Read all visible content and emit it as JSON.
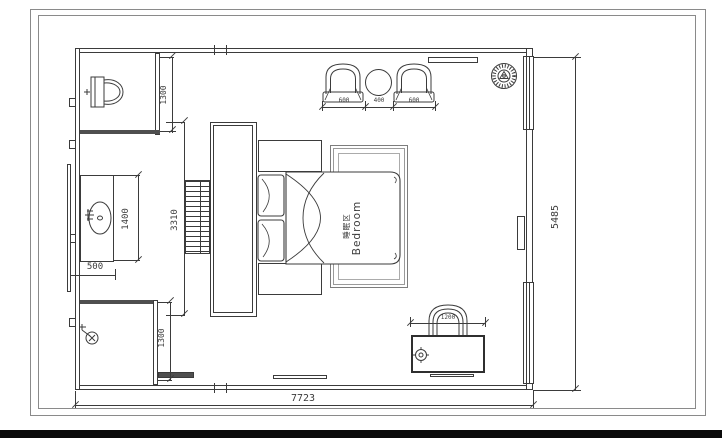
{
  "room": {
    "label_zh": "睡眠区",
    "label_en": "Bedroom"
  },
  "dims": {
    "overall_width": "7723",
    "overall_height": "5485",
    "wc_depth": "1300",
    "shower_depth": "1300",
    "vanity_length": "1400",
    "vanity_depth": "500",
    "wardrobe_length": "3310",
    "seating": [
      "600",
      "400",
      "600"
    ],
    "desk_width": "1200"
  },
  "icons": {
    "toilet-icon": "toilet plan symbol",
    "sink-icon": "wash basin with faucet",
    "shower-icon": "wall-mounted shower head",
    "ceiling-fan-icon": "round hatched fan/vent",
    "armchair-icon": "arched lounge chair",
    "side-table-icon": "round table",
    "bed-icon": "double bed with pillows and throw",
    "desk-chair-icon": "arched desk chair",
    "lamp-icon": "table lamp target symbol"
  },
  "colors": {
    "line": "#3b3b3b",
    "soft": "#8a8a8a",
    "dark": "#4f4f4f",
    "bar": "#0a0a0a",
    "bg": "#ffffff"
  }
}
